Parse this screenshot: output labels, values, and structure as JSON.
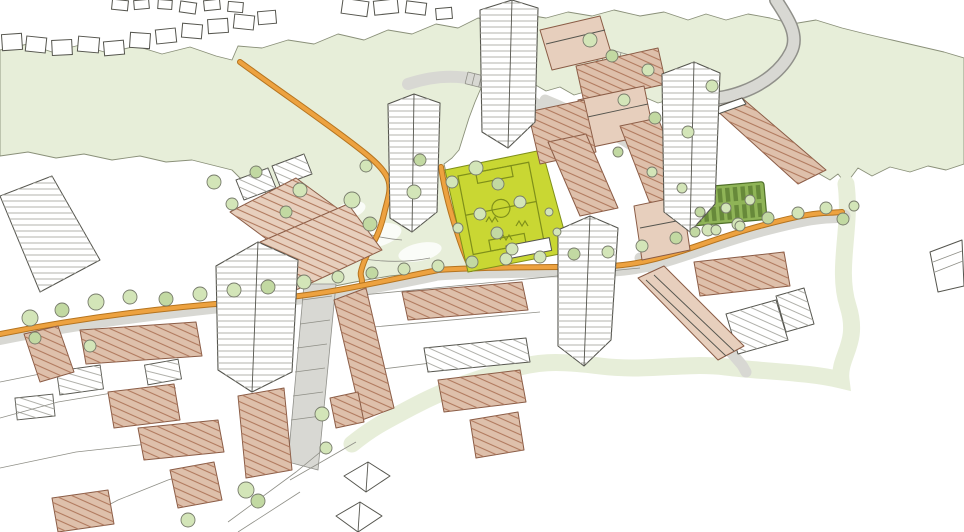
{
  "meta": {
    "kind": "hand-drawn-aerial-masterplan-sketch",
    "subject": "housing estate regeneration masterplan with tower blocks, terraced housing, football pitch, allotments, green fields and orange footpaths",
    "visible_text": ""
  },
  "palette": {
    "field": "#e7eed9",
    "fieldLine": "#8a9079",
    "pitch": "#c9d733",
    "pitchLine": "#7f8f1a",
    "allot": "#8fb457",
    "allotRow": "#67893a",
    "allotLine": "#4f6f28",
    "tree": "#d3e5b8",
    "treeDark": "#c2d9a2",
    "treeStroke": "#777b6b",
    "orange": "#eda240",
    "orangeDark": "#b5741f",
    "road": "#d8d8d3",
    "roadLine": "#90908a",
    "tan": "#dec0ab",
    "tanLight": "#e7cfbd",
    "tanStroke": "#8a5c46",
    "ink": "#55554e",
    "sketch": "#8f8f87",
    "towerLine": "#b3b3ac"
  },
  "scene": {
    "features": [
      "green-fields",
      "park",
      "football-pitch",
      "allotment-gardens",
      "orange-footpaths",
      "access-roads",
      "stream-path",
      "tower-blocks",
      "terraced-housing",
      "apartment-slabs",
      "existing-houses",
      "garages",
      "sheds",
      "trees"
    ],
    "trees": [
      [
        30,
        318,
        8,
        0
      ],
      [
        62,
        310,
        7,
        1
      ],
      [
        96,
        302,
        8,
        0
      ],
      [
        130,
        297,
        7,
        0
      ],
      [
        166,
        299,
        7,
        1
      ],
      [
        200,
        294,
        7,
        0
      ],
      [
        234,
        290,
        7,
        0
      ],
      [
        268,
        287,
        7,
        1
      ],
      [
        304,
        282,
        7,
        0
      ],
      [
        338,
        277,
        6,
        0
      ],
      [
        372,
        273,
        6,
        1
      ],
      [
        404,
        269,
        6,
        0
      ],
      [
        438,
        266,
        6,
        0
      ],
      [
        472,
        262,
        6,
        1
      ],
      [
        506,
        259,
        6,
        0
      ],
      [
        540,
        257,
        6,
        0
      ],
      [
        574,
        254,
        6,
        1
      ],
      [
        608,
        252,
        6,
        0
      ],
      [
        642,
        246,
        6,
        0
      ],
      [
        676,
        238,
        6,
        1
      ],
      [
        708,
        230,
        6,
        0
      ],
      [
        738,
        224,
        6,
        0
      ],
      [
        768,
        218,
        6,
        1
      ],
      [
        798,
        213,
        6,
        0
      ],
      [
        826,
        208,
        6,
        0
      ],
      [
        843,
        219,
        6,
        1
      ],
      [
        854,
        206,
        5,
        0
      ],
      [
        352,
        200,
        8,
        0
      ],
      [
        370,
        224,
        7,
        1
      ],
      [
        414,
        192,
        7,
        0
      ],
      [
        300,
        190,
        7,
        0
      ],
      [
        286,
        212,
        6,
        1
      ],
      [
        452,
        182,
        6,
        0
      ],
      [
        476,
        168,
        7,
        0
      ],
      [
        498,
        184,
        6,
        1
      ],
      [
        520,
        202,
        6,
        0
      ],
      [
        480,
        214,
        6,
        0
      ],
      [
        497,
        233,
        6,
        1
      ],
      [
        512,
        249,
        6,
        0
      ],
      [
        458,
        228,
        5,
        0
      ],
      [
        366,
        166,
        6,
        0
      ],
      [
        420,
        160,
        6,
        1
      ],
      [
        549,
        212,
        4,
        0
      ],
      [
        557,
        232,
        4,
        0
      ],
      [
        590,
        40,
        7,
        0
      ],
      [
        612,
        56,
        6,
        1
      ],
      [
        648,
        70,
        6,
        0
      ],
      [
        624,
        100,
        6,
        0
      ],
      [
        655,
        118,
        6,
        1
      ],
      [
        688,
        132,
        6,
        0
      ],
      [
        712,
        86,
        6,
        0
      ],
      [
        618,
        152,
        5,
        1
      ],
      [
        652,
        172,
        5,
        0
      ],
      [
        682,
        188,
        5,
        0
      ],
      [
        700,
        212,
        5,
        1
      ],
      [
        726,
        208,
        5,
        0
      ],
      [
        750,
        200,
        5,
        0
      ],
      [
        695,
        232,
        5,
        1
      ],
      [
        716,
        230,
        5,
        0
      ],
      [
        740,
        226,
        5,
        0
      ],
      [
        214,
        182,
        7,
        0
      ],
      [
        256,
        172,
        6,
        1
      ],
      [
        232,
        204,
        6,
        0
      ],
      [
        188,
        520,
        7,
        0
      ],
      [
        246,
        490,
        8,
        0
      ],
      [
        258,
        501,
        7,
        1
      ],
      [
        322,
        414,
        7,
        0
      ],
      [
        326,
        448,
        6,
        0
      ],
      [
        35,
        338,
        6,
        1
      ],
      [
        90,
        346,
        6,
        0
      ]
    ],
    "existing_houses": [
      [
        2,
        34,
        20,
        16,
        -4
      ],
      [
        26,
        37,
        20,
        15,
        6
      ],
      [
        52,
        40,
        20,
        15,
        -3
      ],
      [
        78,
        37,
        21,
        15,
        5
      ],
      [
        104,
        41,
        20,
        14,
        -5
      ],
      [
        130,
        33,
        20,
        15,
        4
      ],
      [
        156,
        29,
        20,
        14,
        -6
      ],
      [
        182,
        24,
        20,
        14,
        5
      ],
      [
        208,
        19,
        20,
        14,
        -4
      ],
      [
        234,
        15,
        20,
        14,
        6
      ],
      [
        258,
        11,
        18,
        13,
        -5
      ],
      [
        180,
        2,
        16,
        11,
        8
      ],
      [
        204,
        0,
        16,
        10,
        -6
      ],
      [
        228,
        2,
        15,
        10,
        5
      ],
      [
        112,
        0,
        16,
        10,
        6
      ],
      [
        134,
        0,
        15,
        9,
        -5
      ],
      [
        158,
        0,
        14,
        9,
        4
      ],
      [
        342,
        0,
        26,
        15,
        8
      ],
      [
        374,
        0,
        24,
        14,
        -6
      ],
      [
        406,
        2,
        20,
        12,
        7
      ],
      [
        436,
        8,
        16,
        11,
        -5
      ]
    ],
    "garages": [
      [
        58,
        368,
        44,
        24,
        -8
      ],
      [
        16,
        396,
        38,
        22,
        -6
      ],
      [
        146,
        362,
        34,
        20,
        -10
      ]
    ]
  }
}
